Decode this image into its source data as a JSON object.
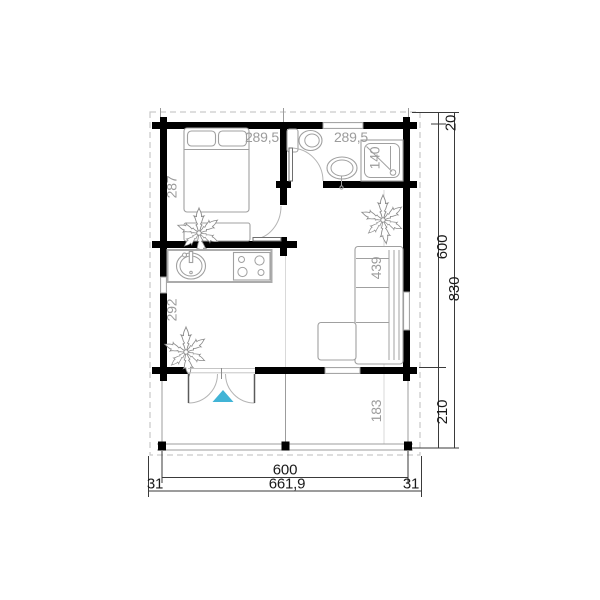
{
  "colors": {
    "accent": "#41b4d6",
    "wall": "#000000",
    "furniture_line": "#a0a0a0",
    "interior_label": "#9c9c9c",
    "dimension_text": "#1a1a1a",
    "roof_dash": "#c9c9c9"
  },
  "interior_dims": {
    "bedroom_width": "289,5",
    "bathroom_width": "289,5",
    "bedroom_depth": "287",
    "shower_width": "140",
    "living_depth_right": "439",
    "living_depth_left": "292",
    "terrace_depth_inner": "183"
  },
  "exterior_dims": {
    "roof_overhang_top": "20",
    "cabin_depth": "600",
    "total_depth": "830",
    "terrace_depth": "210",
    "cabin_width": "600",
    "total_width": "661,9",
    "overhang_left": "31",
    "overhang_right": "31"
  }
}
